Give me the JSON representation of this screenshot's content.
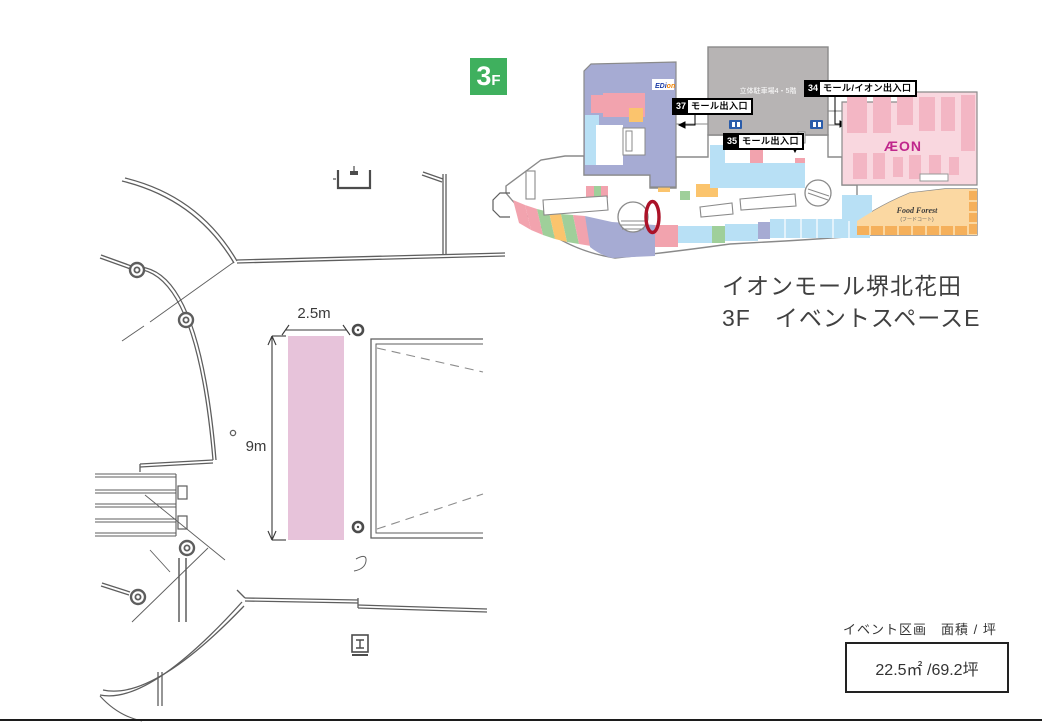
{
  "floor_badge": {
    "number": "3",
    "suffix": "F",
    "color": "#3fb05e"
  },
  "map": {
    "parking_label": "立体駐車場4・5階",
    "edion_logo": {
      "blue": "EDi",
      "orange": "on"
    },
    "aeon_logo": "ÆON",
    "food_court": {
      "name": "Food Forest",
      "subtitle": "(フードコート)"
    },
    "entrances": [
      {
        "num": "37",
        "label": "モール出入口"
      },
      {
        "num": "35",
        "label": "モール出入口"
      },
      {
        "num": "34",
        "label": "モール/イオン出入口"
      }
    ],
    "colors": {
      "tenant_lavender": "#a6abd3",
      "tenant_pink": "#f2a3ae",
      "tenant_green": "#9fcf9a",
      "tenant_orange": "#fbc46d",
      "tenant_lightblue": "#b8e0f5",
      "aeon_pink": "#f9d7df",
      "aeon_stripe": "#f3b6c4",
      "aeon_logo_magenta": "#c0268c",
      "food_orange": "#fbd8a2",
      "food_cell": "#f5b05b",
      "parking_gray": "#b7b4b4",
      "marker_red": "#ab1228"
    }
  },
  "title": {
    "line1": "イオンモール堺北花田",
    "line2": "3F　イベントスペースE"
  },
  "plan": {
    "width_label": "2.5m",
    "height_label": "9m",
    "space_fill": "#e7c3da"
  },
  "area_info": {
    "heading": "イベント区画　面積 / 坪",
    "value": "22.5㎡ /69.2坪"
  }
}
